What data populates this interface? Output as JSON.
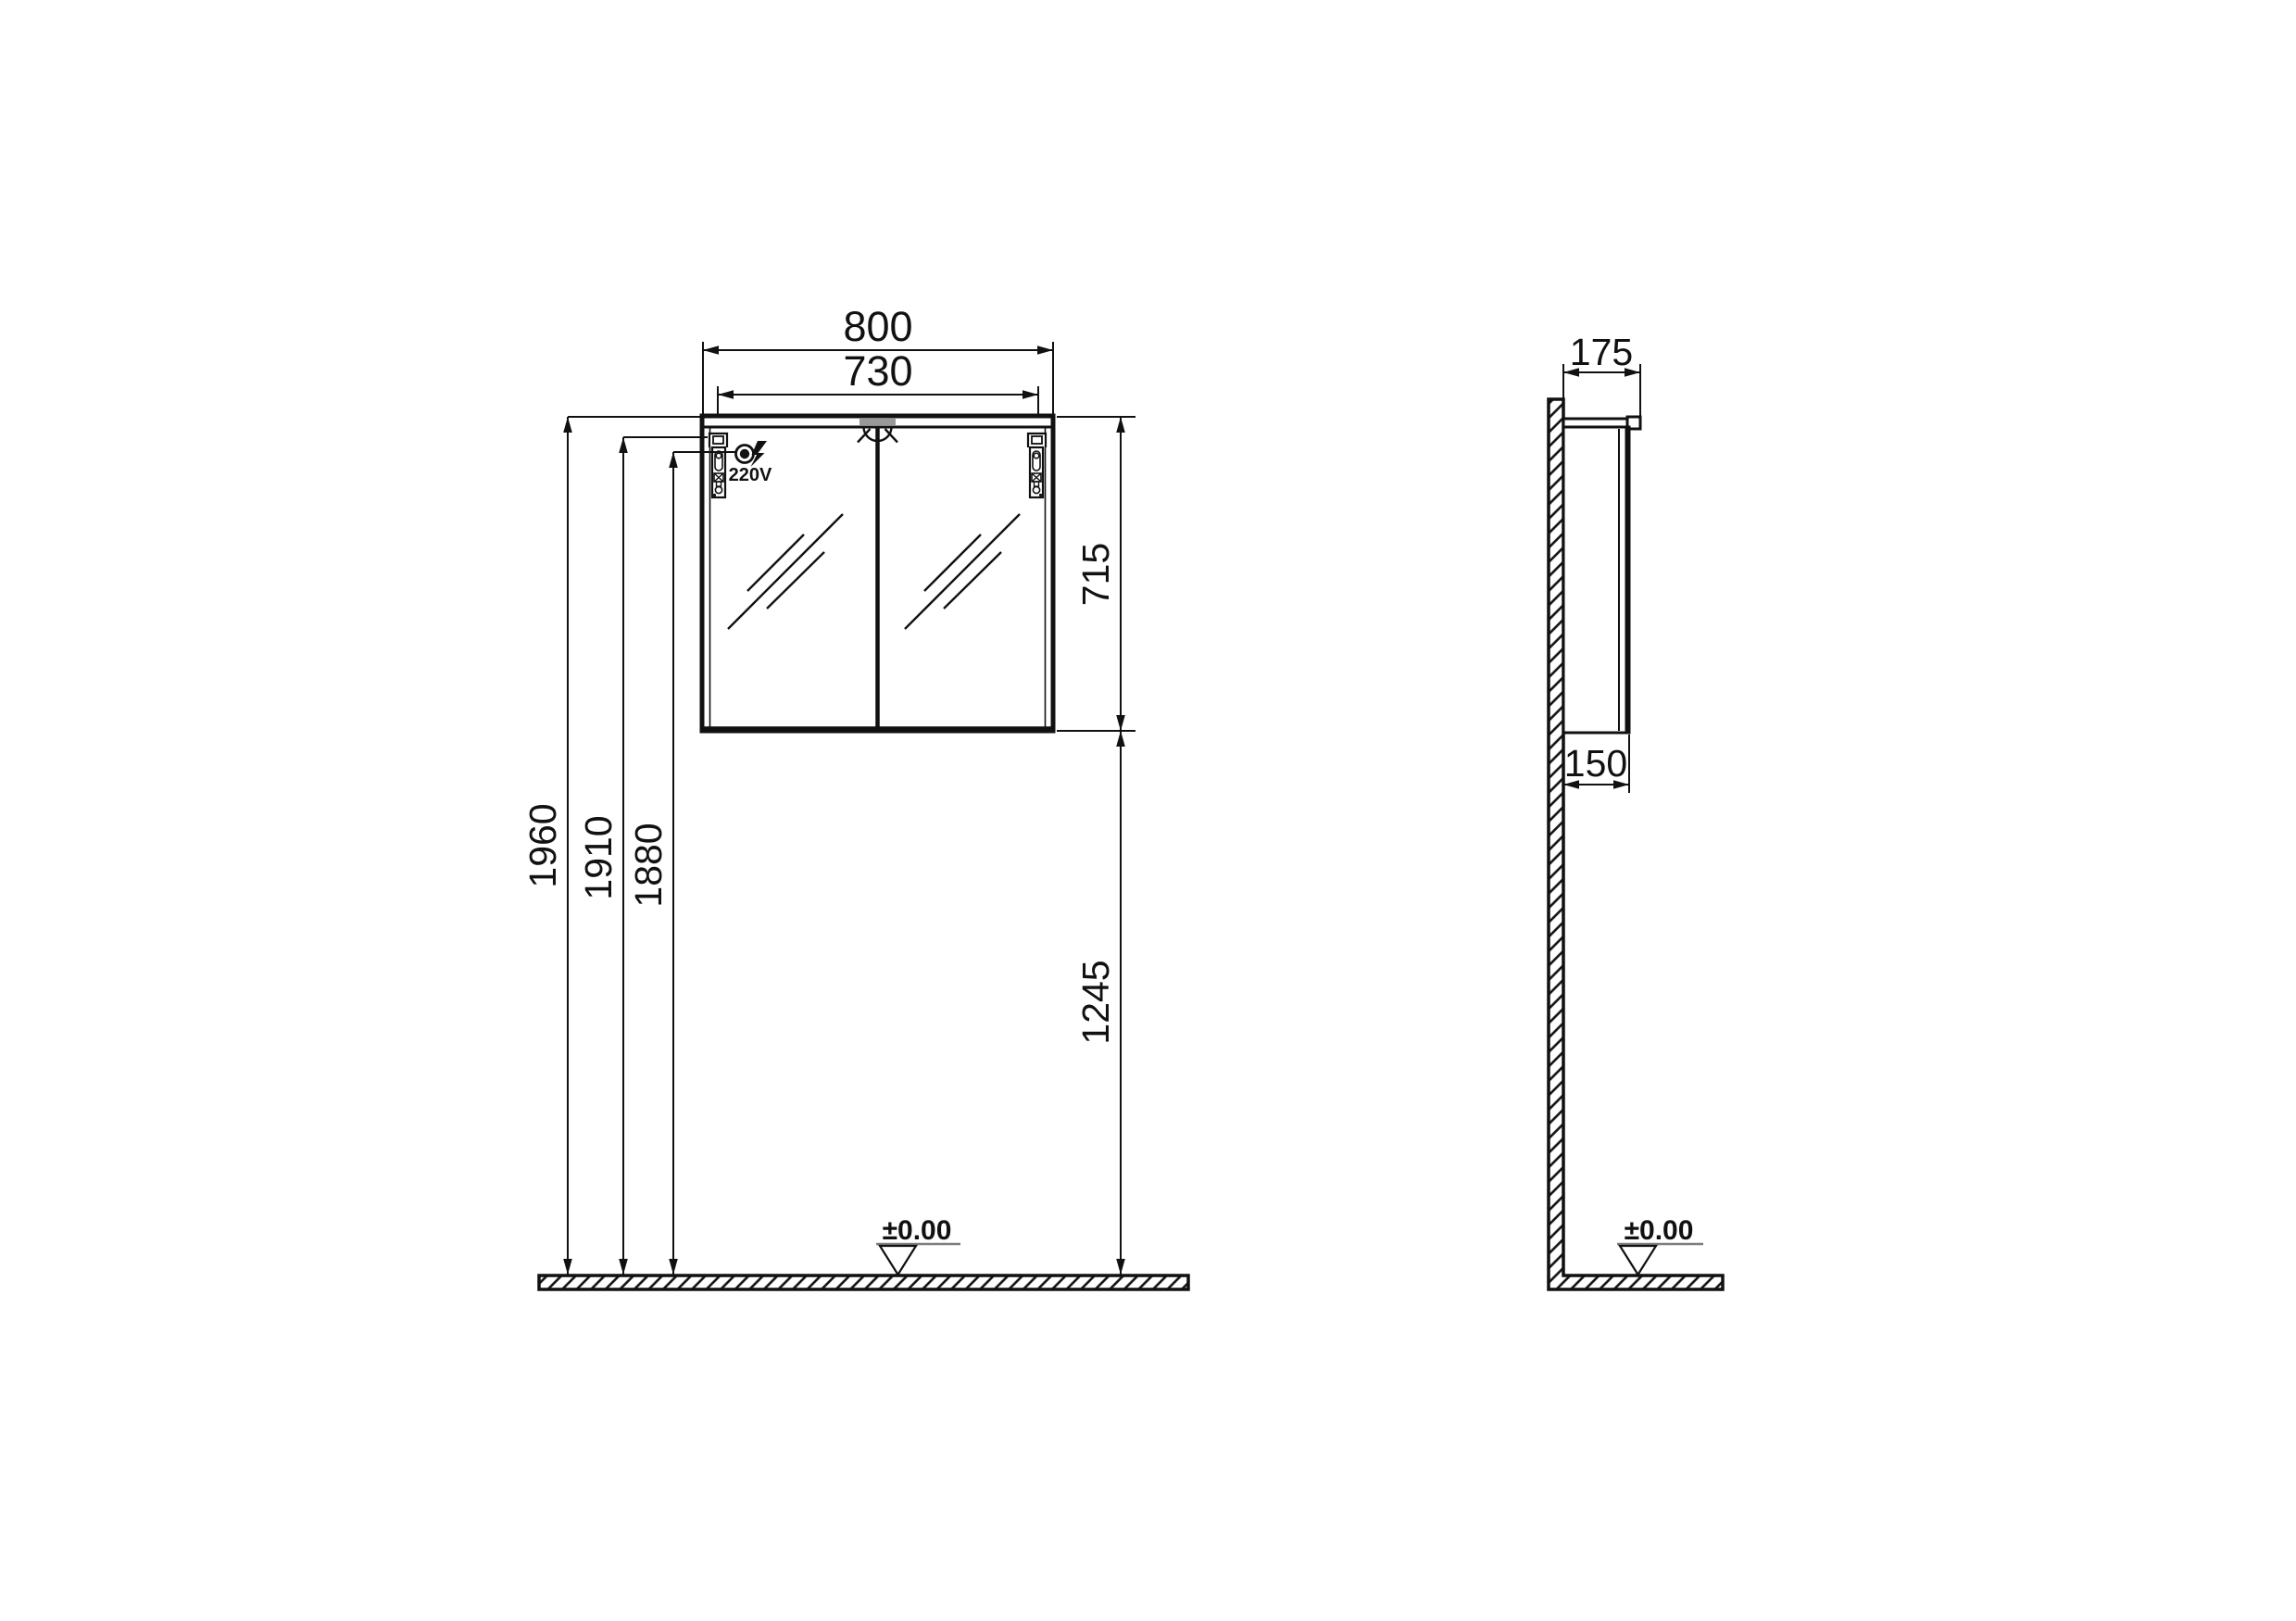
{
  "front_view": {
    "dims": {
      "outer_width": "800",
      "hinge_spacing": "730",
      "cabinet_height": "715",
      "bottom_to_floor": "1245",
      "top_height": "1960",
      "hinge_height": "1910",
      "socket_height": "1880"
    },
    "socket_label": "220V",
    "floor_level": "±0.00"
  },
  "side_view": {
    "dims": {
      "top_depth": "175",
      "body_depth": "150"
    },
    "floor_level": "±0.00"
  },
  "colors": {
    "line": "#111111",
    "light_strip": "#999999",
    "datum_underline": "#7d7d7d"
  }
}
